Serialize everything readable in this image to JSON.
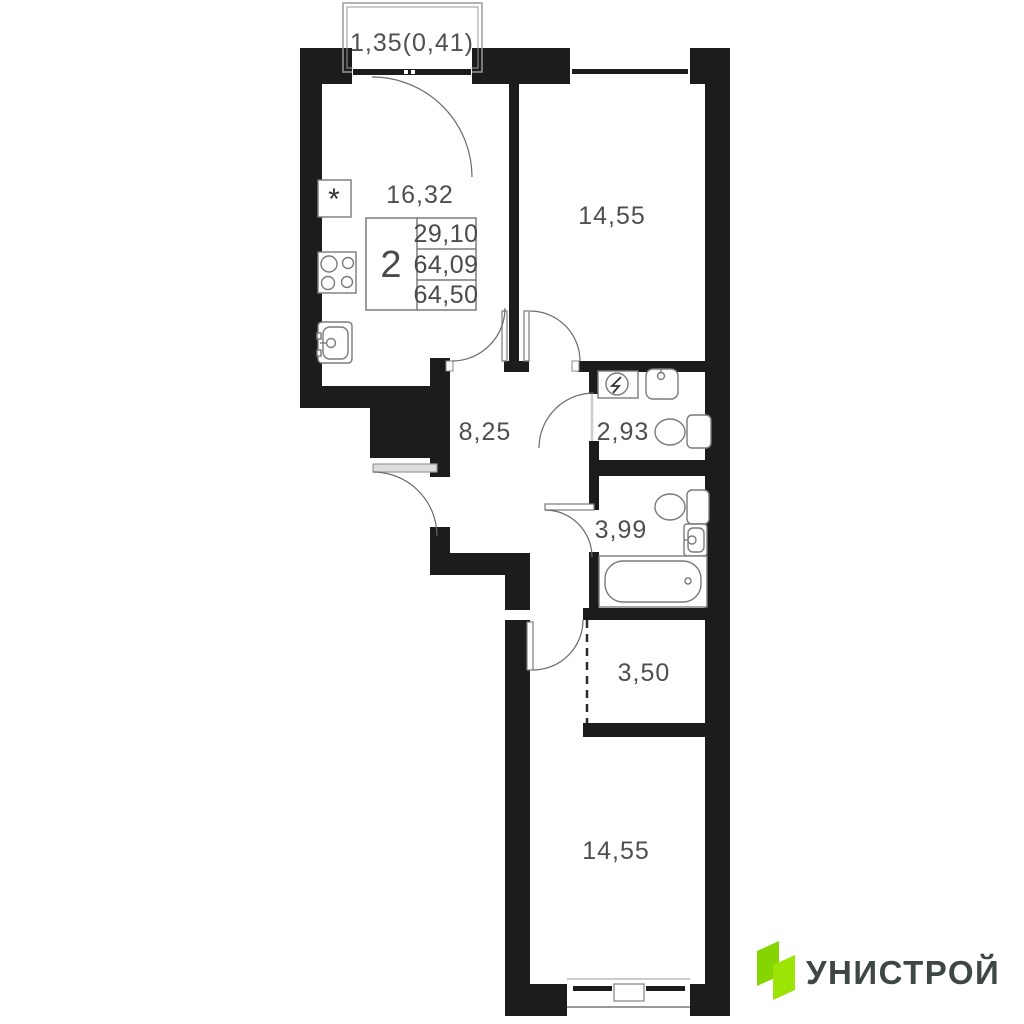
{
  "plan": {
    "balcony": {
      "label": "1,35(0,41)"
    },
    "rooms": {
      "kitchen": "16,32",
      "bedroom_top": "14,55",
      "hallway": "8,25",
      "wc": "2,93",
      "bathroom": "3,99",
      "wardrobe": "3,50",
      "bedroom_bottom": "14,55"
    },
    "info_table": {
      "rooms_count": "2",
      "living_area": "29,10",
      "area_no_balcony": "64,09",
      "total_area": "64,50"
    },
    "fixture_marks": {
      "fridge_mark": "*"
    }
  },
  "logo": {
    "brand": "УНИСТРОЙ"
  },
  "colors": {
    "wall": "#1c1c1c",
    "label_text": "#4f4f4f",
    "logo_green_left": "#85D502",
    "logo_green_right": "#9CE406",
    "logo_text": "#3D4845"
  }
}
